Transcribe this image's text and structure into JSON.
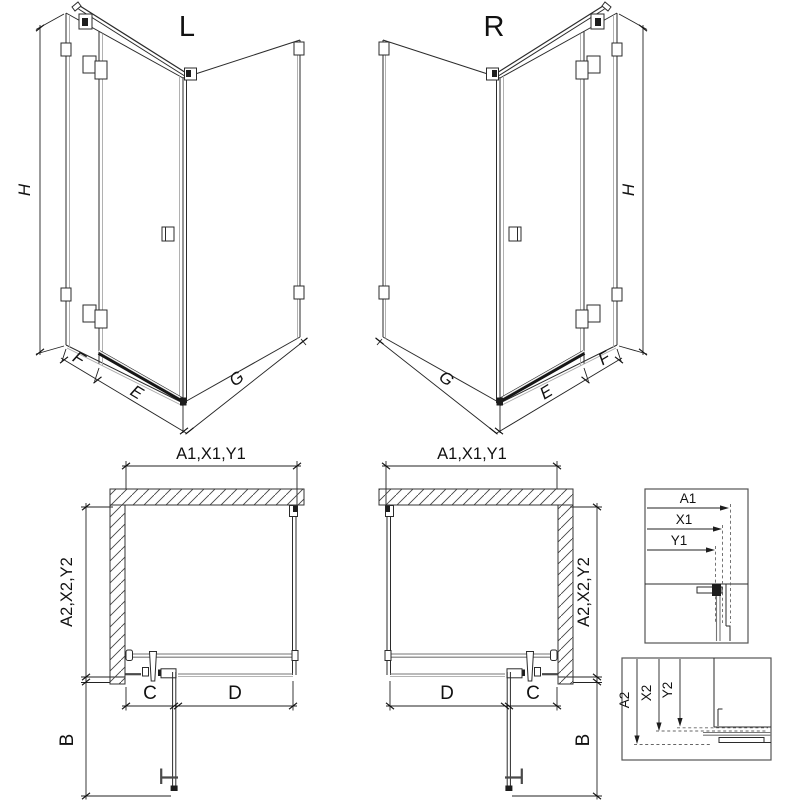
{
  "drawing": {
    "iso_left": {
      "label": "L",
      "dim_height": "H",
      "dim_fixed": "F",
      "dim_door": "E",
      "dim_side": "G"
    },
    "iso_right": {
      "label": "R",
      "dim_height": "H",
      "dim_fixed": "F",
      "dim_door": "E",
      "dim_side": "G"
    },
    "plan_left": {
      "dim_top": "A1,X1,Y1",
      "dim_side": "A2,X2,Y2",
      "dim_wall_to_hinge": "C",
      "dim_door": "D",
      "dim_swing": "B"
    },
    "plan_right": {
      "dim_top": "A1,X1,Y1",
      "dim_side": "A2,X2,Y2",
      "dim_wall_to_hinge": "C",
      "dim_door": "D",
      "dim_swing": "B"
    },
    "detail_top": {
      "dim1": "A1",
      "dim2": "X1",
      "dim3": "Y1"
    },
    "detail_bottom": {
      "dim1": "A2",
      "dim2": "X2",
      "dim3": "Y2"
    }
  },
  "colors": {
    "line": "#2b2b2b",
    "glass_edge": "#a9a9a9",
    "rail": "#161616",
    "background": "#ffffff"
  }
}
